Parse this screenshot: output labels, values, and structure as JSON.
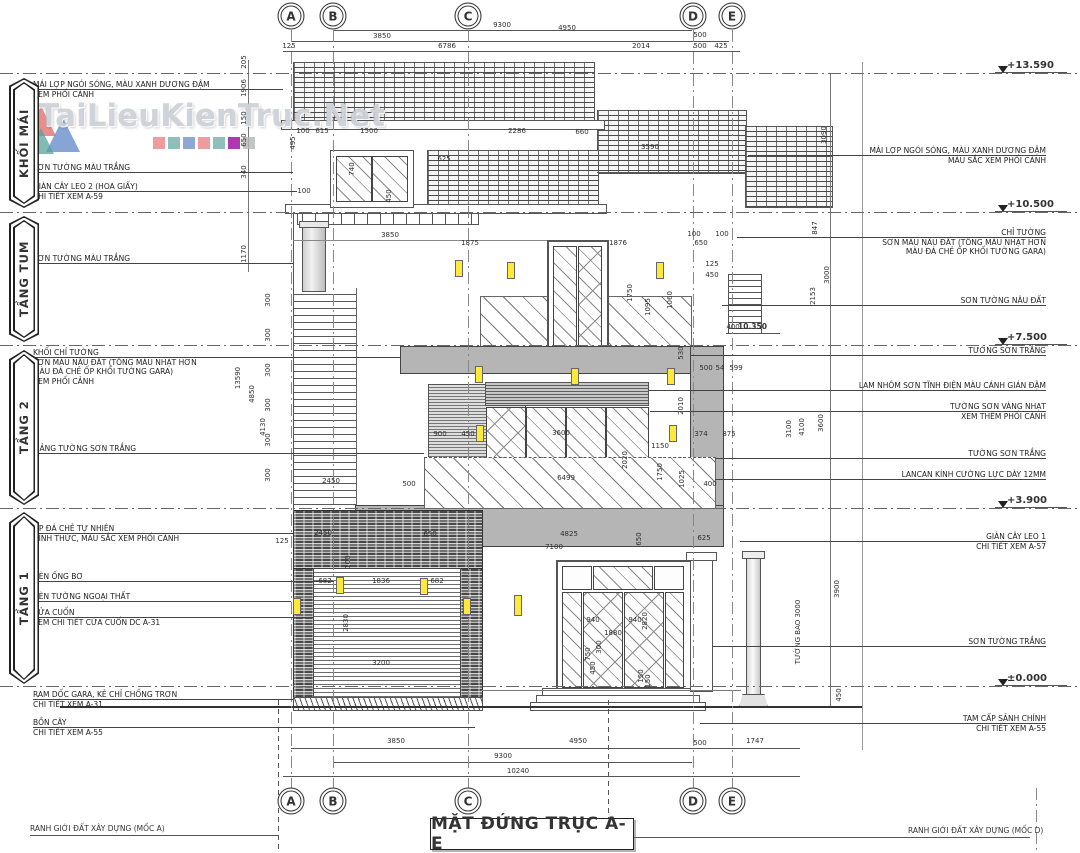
{
  "title": "MẶT ĐỨNG TRỤC A-E",
  "watermark": {
    "text": "TaiLieuKienTruc.Net",
    "logo_colors": [
      "#e06565",
      "#57a29a",
      "#5d86c6"
    ],
    "square_colors": [
      "#e88585",
      "#74aea6",
      "#7392c8",
      "#e88585",
      "#74aea6",
      "#98079a",
      "#b5b5b5"
    ]
  },
  "accent_colors": {
    "light_fixture": "#ffe93a",
    "wall_block_gray": "#b5b5b5",
    "line": "#444444"
  },
  "grid_axes": [
    {
      "label": "A",
      "x": 291
    },
    {
      "label": "B",
      "x": 333
    },
    {
      "label": "C",
      "x": 468
    },
    {
      "label": "D",
      "x": 693
    },
    {
      "label": "E",
      "x": 732
    }
  ],
  "levels": [
    {
      "label": "+13.590",
      "y": 73
    },
    {
      "label": "+10.500",
      "y": 212
    },
    {
      "label": "+7.500",
      "y": 345
    },
    {
      "label": "+3.900",
      "y": 508
    },
    {
      "label": "±0.000",
      "y": 686
    }
  ],
  "inner_level": {
    "label": "10.350",
    "x": 752,
    "y": 329
  },
  "sections": [
    {
      "label": "KHỐI MÁI",
      "y": 78,
      "h": 130
    },
    {
      "label": "TẦNG TUM",
      "y": 216,
      "h": 126
    },
    {
      "label": "TẦNG 2",
      "y": 350,
      "h": 155
    },
    {
      "label": "TẦNG 1",
      "y": 512,
      "h": 172
    }
  ],
  "left_annotations": [
    {
      "y": 80,
      "leader_to": 283,
      "lines": [
        "MÁI LỢP NGÓI SÓNG, MÀU XANH DƯƠNG ĐẬM",
        "XEM PHỐI CẢNH"
      ]
    },
    {
      "y": 163,
      "leader_to": 293,
      "lines": [
        "SƠN TƯỜNG MÀU TRẮNG"
      ]
    },
    {
      "y": 182,
      "leader_to": 297,
      "lines": [
        "GIÀN CÂY LEO 2 (HOA GIẤY)",
        "CHI TIẾT XEM A-59"
      ]
    },
    {
      "y": 254,
      "leader_to": 293,
      "lines": [
        "SƠN TƯỜNG MÀU TRẮNG"
      ]
    },
    {
      "y": 348,
      "leader_to": 400,
      "lines": [
        "KHỐI CHỈ TƯỜNG",
        "SƠN MÀU NÂU ĐẤT (TÔNG MÀU NHẠT HƠN",
        "MÀU ĐÁ CHẺ ỐP KHỐI TƯỜNG GARA)",
        "XEM PHỐI CẢNH"
      ]
    },
    {
      "y": 444,
      "leader_to": 424,
      "lines": [
        "MẢNG TƯỜNG SƠN TRẮNG"
      ]
    },
    {
      "y": 524,
      "leader_to": 293,
      "lines": [
        "ỐP ĐÁ CHẺ TỰ NHIÊN",
        "HÌNH THỨC, MÀU SẮC XEM PHỐI CẢNH"
      ]
    },
    {
      "y": 572,
      "leader_to": 334,
      "lines": [
        "ĐÈN ỐNG BƠ"
      ]
    },
    {
      "y": 592,
      "leader_to": 291,
      "lines": [
        "ĐÈN TƯỜNG NGOẠI THẤT"
      ]
    },
    {
      "y": 608,
      "leader_to": 313,
      "lines": [
        "CỬA CUỐN",
        "XEM CHI TIẾT CỬA CUỐN DC A-31"
      ]
    },
    {
      "y": 690,
      "leader_to": 293,
      "lines": [
        "RAM DỐC GARA, KẺ CHỈ CHỐNG TRƠN",
        "CHI TIẾT XEM A-31"
      ]
    },
    {
      "y": 718,
      "leader_to": 475,
      "lines": [
        "BỒN CÂY",
        "CHI TIẾT XEM A-55"
      ]
    }
  ],
  "right_annotations": [
    {
      "y": 146,
      "leader_from": 748,
      "lines": [
        "MÁI LỢP NGÓI SÓNG, MÀU XANH DƯƠNG ĐẬM",
        "MÀU SẮC XEM PHỐI CẢNH"
      ]
    },
    {
      "y": 228,
      "leader_from": 737,
      "lines": [
        "CHỈ TƯỜNG",
        "SƠN MÀU NÂU ĐẤT (TÔNG MÀU NHẠT HƠN",
        "MÀU ĐÁ CHẺ ỐP KHỐI TƯỜNG GARA)"
      ]
    },
    {
      "y": 296,
      "leader_from": 722,
      "lines": [
        "SƠN TƯỜNG NÂU ĐẤT"
      ]
    },
    {
      "y": 346,
      "leader_from": 690,
      "lines": [
        "TƯỜNG SƠN TRẮNG"
      ]
    },
    {
      "y": 381,
      "leader_from": 648,
      "lines": [
        "LAM NHÔM SƠN TĨNH ĐIỆN MÀU CÁNH GIÁN ĐẬM"
      ]
    },
    {
      "y": 402,
      "leader_from": 650,
      "lines": [
        "TƯỜNG SƠN VÀNG NHẠT",
        "XEM THÊM PHỐI CẢNH"
      ]
    },
    {
      "y": 449,
      "leader_from": 715,
      "lines": [
        "TƯỜNG SƠN TRẮNG"
      ]
    },
    {
      "y": 470,
      "leader_from": 715,
      "lines": [
        "LANCAN KÍNH CƯỜNG LỰC DÀY 12MM"
      ]
    },
    {
      "y": 532,
      "leader_from": 740,
      "lines": [
        "GIÀN CÂY LEO 1",
        "CHI TIẾT XEM A-57"
      ]
    },
    {
      "y": 637,
      "leader_from": 712,
      "lines": [
        "SƠN TƯỜNG TRẮNG"
      ]
    },
    {
      "y": 714,
      "leader_from": 700,
      "lines": [
        "TAM CẤP SẢNH CHÍNH",
        "CHI TIẾT XEM A-55"
      ]
    }
  ],
  "footer": {
    "left": "RANH GIỚI ĐẤT XÂY DỰNG (MỐC A)",
    "right": "RANH GIỚI ĐẤT XÂY DỰNG (MỐC D)"
  },
  "dims": [
    {
      "t": "9300",
      "x": 502,
      "y": 25
    },
    {
      "t": "4950",
      "x": 567,
      "y": 28
    },
    {
      "t": "3850",
      "x": 382,
      "y": 36
    },
    {
      "t": "500",
      "x": 700,
      "y": 35
    },
    {
      "t": "125",
      "x": 289,
      "y": 46
    },
    {
      "t": "6786",
      "x": 447,
      "y": 46
    },
    {
      "t": "2014",
      "x": 641,
      "y": 46
    },
    {
      "t": "500",
      "x": 700,
      "y": 46
    },
    {
      "t": "425",
      "x": 721,
      "y": 46
    },
    {
      "t": "205",
      "x": 244,
      "y": 62,
      "r": 1
    },
    {
      "t": "1906",
      "x": 244,
      "y": 88,
      "r": 1
    },
    {
      "t": "150",
      "x": 244,
      "y": 118,
      "r": 1
    },
    {
      "t": "650",
      "x": 244,
      "y": 140,
      "r": 1
    },
    {
      "t": "340",
      "x": 244,
      "y": 172,
      "r": 1
    },
    {
      "t": "1170",
      "x": 244,
      "y": 254,
      "r": 1
    },
    {
      "t": "13590",
      "x": 238,
      "y": 378,
      "r": 1
    },
    {
      "t": "4850",
      "x": 252,
      "y": 394,
      "r": 1
    },
    {
      "t": "4130",
      "x": 263,
      "y": 427,
      "r": 1
    },
    {
      "t": "100",
      "x": 303,
      "y": 131
    },
    {
      "t": "615",
      "x": 322,
      "y": 131
    },
    {
      "t": "1500",
      "x": 369,
      "y": 131
    },
    {
      "t": "2286",
      "x": 517,
      "y": 131
    },
    {
      "t": "660",
      "x": 582,
      "y": 132
    },
    {
      "t": "3590",
      "x": 650,
      "y": 147
    },
    {
      "t": "625",
      "x": 444,
      "y": 159
    },
    {
      "t": "495",
      "x": 293,
      "y": 143,
      "r": 1
    },
    {
      "t": "740",
      "x": 352,
      "y": 169,
      "r": 1
    },
    {
      "t": "450",
      "x": 389,
      "y": 196,
      "r": 1
    },
    {
      "t": "100",
      "x": 304,
      "y": 191
    },
    {
      "t": "3850",
      "x": 390,
      "y": 235
    },
    {
      "t": "1875",
      "x": 470,
      "y": 243
    },
    {
      "t": "1876",
      "x": 618,
      "y": 243
    },
    {
      "t": "100",
      "x": 694,
      "y": 234
    },
    {
      "t": "100",
      "x": 722,
      "y": 234
    },
    {
      "t": "650",
      "x": 701,
      "y": 243
    },
    {
      "t": "125",
      "x": 712,
      "y": 264
    },
    {
      "t": "450",
      "x": 712,
      "y": 275
    },
    {
      "t": "1750",
      "x": 630,
      "y": 293,
      "r": 1
    },
    {
      "t": "1095",
      "x": 648,
      "y": 307,
      "r": 1
    },
    {
      "t": "1060",
      "x": 670,
      "y": 300,
      "r": 1
    },
    {
      "t": "400",
      "x": 733,
      "y": 327
    },
    {
      "t": "847",
      "x": 815,
      "y": 228,
      "r": 1
    },
    {
      "t": "2153",
      "x": 813,
      "y": 296,
      "r": 1
    },
    {
      "t": "3000",
      "x": 827,
      "y": 275,
      "r": 1
    },
    {
      "t": "3090",
      "x": 824,
      "y": 135,
      "r": 1
    },
    {
      "t": "530",
      "x": 681,
      "y": 353,
      "r": 1
    },
    {
      "t": "500",
      "x": 706,
      "y": 368
    },
    {
      "t": "54",
      "x": 720,
      "y": 368
    },
    {
      "t": "599",
      "x": 736,
      "y": 368
    },
    {
      "t": "900",
      "x": 440,
      "y": 434
    },
    {
      "t": "450",
      "x": 468,
      "y": 434
    },
    {
      "t": "3600",
      "x": 561,
      "y": 433
    },
    {
      "t": "1150",
      "x": 660,
      "y": 446
    },
    {
      "t": "2010",
      "x": 681,
      "y": 406,
      "r": 1
    },
    {
      "t": "374",
      "x": 701,
      "y": 434
    },
    {
      "t": "875",
      "x": 729,
      "y": 434
    },
    {
      "t": "2450",
      "x": 331,
      "y": 481
    },
    {
      "t": "500",
      "x": 409,
      "y": 484
    },
    {
      "t": "6499",
      "x": 566,
      "y": 478
    },
    {
      "t": "2020",
      "x": 625,
      "y": 460,
      "r": 1
    },
    {
      "t": "1750",
      "x": 660,
      "y": 472,
      "r": 1
    },
    {
      "t": "1025",
      "x": 682,
      "y": 479,
      "r": 1
    },
    {
      "t": "400",
      "x": 710,
      "y": 484
    },
    {
      "t": "3600",
      "x": 821,
      "y": 423,
      "r": 1
    },
    {
      "t": "3100",
      "x": 789,
      "y": 429,
      "r": 1
    },
    {
      "t": "4100",
      "x": 802,
      "y": 427,
      "r": 1
    },
    {
      "t": "300",
      "x": 268,
      "y": 300,
      "r": 1
    },
    {
      "t": "300",
      "x": 268,
      "y": 335,
      "r": 1
    },
    {
      "t": "300",
      "x": 268,
      "y": 370,
      "r": 1
    },
    {
      "t": "300",
      "x": 268,
      "y": 405,
      "r": 1
    },
    {
      "t": "300",
      "x": 268,
      "y": 440,
      "r": 1
    },
    {
      "t": "300",
      "x": 268,
      "y": 475,
      "r": 1
    },
    {
      "t": "2450",
      "x": 323,
      "y": 533
    },
    {
      "t": "650",
      "x": 430,
      "y": 534
    },
    {
      "t": "125",
      "x": 282,
      "y": 541
    },
    {
      "t": "100",
      "x": 348,
      "y": 562,
      "r": 1
    },
    {
      "t": "682",
      "x": 325,
      "y": 581
    },
    {
      "t": "1836",
      "x": 381,
      "y": 581
    },
    {
      "t": "682",
      "x": 437,
      "y": 581
    },
    {
      "t": "2830",
      "x": 346,
      "y": 623,
      "r": 1
    },
    {
      "t": "3200",
      "x": 381,
      "y": 663
    },
    {
      "t": "4825",
      "x": 569,
      "y": 534
    },
    {
      "t": "7100",
      "x": 554,
      "y": 547
    },
    {
      "t": "650",
      "x": 639,
      "y": 539,
      "r": 1
    },
    {
      "t": "625",
      "x": 704,
      "y": 538
    },
    {
      "t": "940",
      "x": 593,
      "y": 620
    },
    {
      "t": "940",
      "x": 635,
      "y": 620
    },
    {
      "t": "1880",
      "x": 613,
      "y": 633
    },
    {
      "t": "2820",
      "x": 645,
      "y": 621,
      "r": 1
    },
    {
      "t": "750",
      "x": 588,
      "y": 654,
      "r": 1
    },
    {
      "t": "450",
      "x": 593,
      "y": 668,
      "r": 1
    },
    {
      "t": "300",
      "x": 599,
      "y": 647,
      "r": 1
    },
    {
      "t": "150",
      "x": 641,
      "y": 676,
      "r": 1
    },
    {
      "t": "150",
      "x": 648,
      "y": 681,
      "r": 1
    },
    {
      "t": "3900",
      "x": 837,
      "y": 589,
      "r": 1
    },
    {
      "t": "450",
      "x": 839,
      "y": 695,
      "r": 1
    },
    {
      "t": "TƯỜNG BAO 3000",
      "x": 798,
      "y": 632,
      "r": 1
    },
    {
      "t": "3850",
      "x": 396,
      "y": 741
    },
    {
      "t": "4950",
      "x": 578,
      "y": 741
    },
    {
      "t": "500",
      "x": 700,
      "y": 743
    },
    {
      "t": "1747",
      "x": 755,
      "y": 741
    },
    {
      "t": "9300",
      "x": 503,
      "y": 756
    },
    {
      "t": "10240",
      "x": 518,
      "y": 771
    }
  ]
}
